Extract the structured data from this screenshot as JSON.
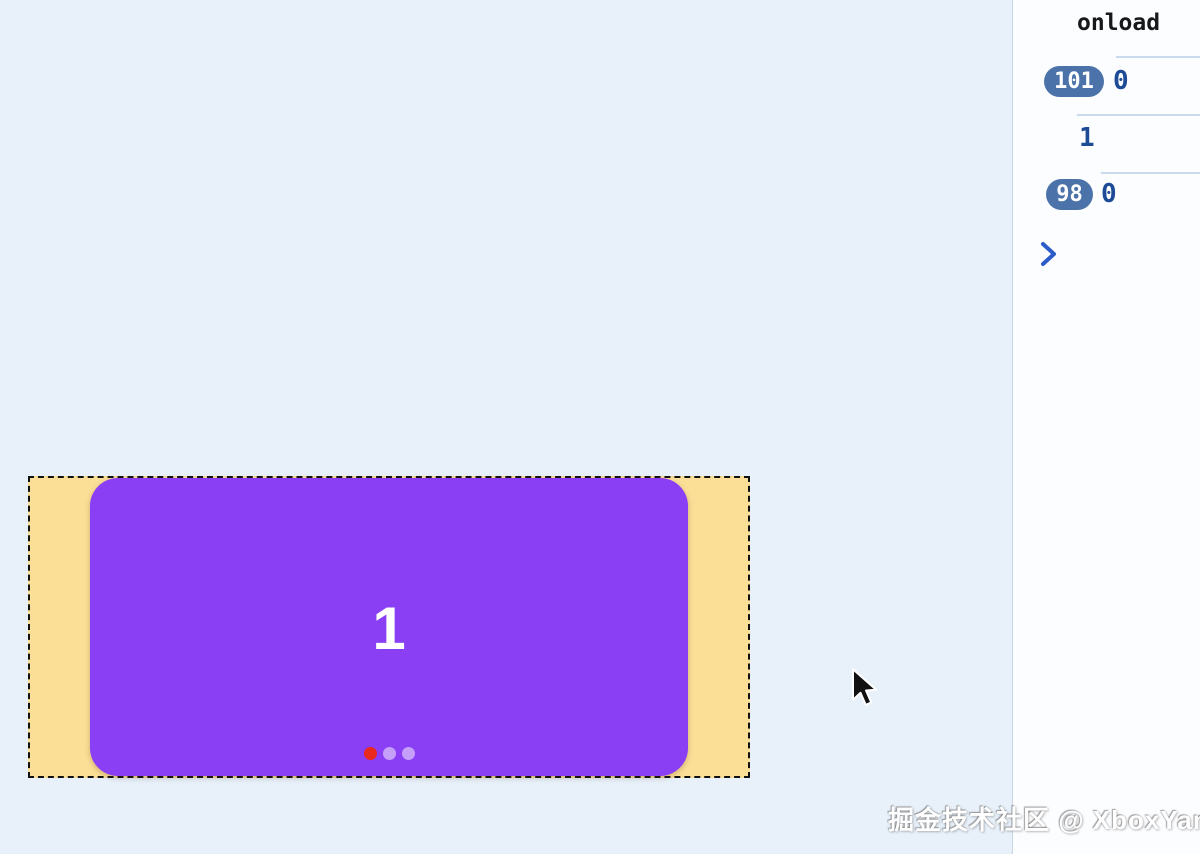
{
  "carousel": {
    "slide_number": "1",
    "dots": [
      "active",
      "inactive",
      "inactive"
    ],
    "slide_color": "#8A3FF5",
    "track_color": "#FBDF97",
    "active_dot_color": "#E8291C"
  },
  "console": {
    "title": "onload",
    "entries": [
      {
        "count": "101",
        "value": "0"
      },
      {
        "count": "",
        "value": "1"
      },
      {
        "count": "98",
        "value": "0"
      }
    ],
    "prompt_icon": "chevron-right-icon",
    "badge_color": "#4B73A9",
    "value_color": "#1D4B96"
  },
  "watermark": "掘金技术社区 @ XboxYan",
  "colors": {
    "stage_background": "#E8F1FA",
    "panel_background": "#FCFDFF",
    "panel_border": "#CBD6E5",
    "divider": "#C9DAEE"
  }
}
